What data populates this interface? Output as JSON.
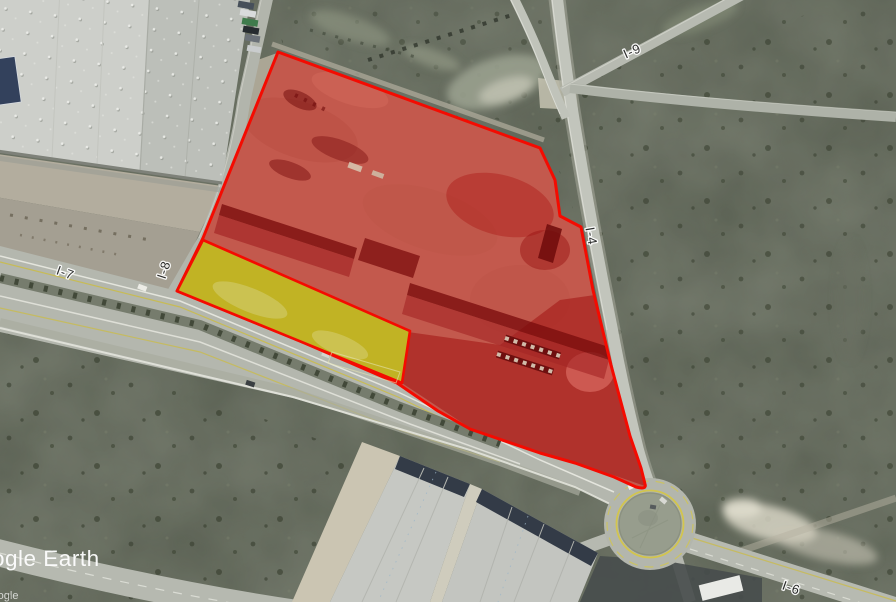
{
  "map": {
    "road_labels": {
      "i4": "I-4",
      "i6": "I-6",
      "i7": "I-7",
      "i8": "I-8",
      "i9": "I-9"
    },
    "watermark": {
      "primary": "Google Earth",
      "secondary": "Google"
    },
    "colors": {
      "parcel_fill": "#e3261b",
      "parcel_stroke": "#f40b01",
      "subparcel_fill": "#c1bc20",
      "subparcel_stroke": "#f40b01",
      "marking_yellow": "#d2c54e"
    }
  }
}
